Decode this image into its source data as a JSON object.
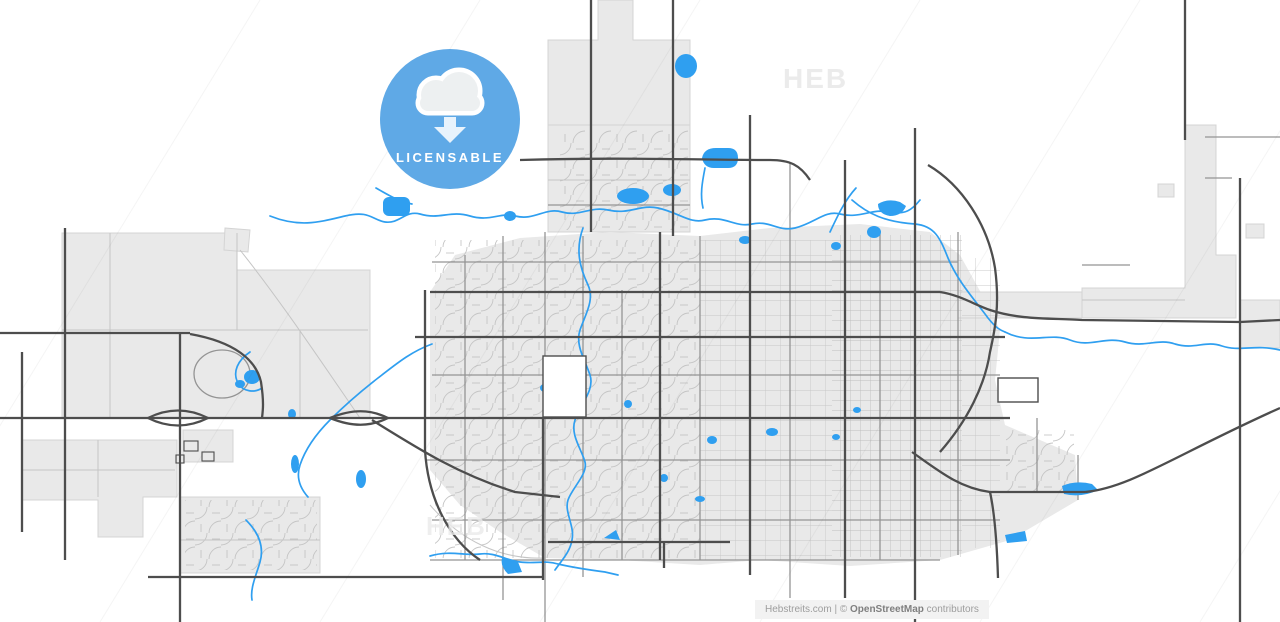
{
  "badge": {
    "label": "LICENSABLE",
    "icon": "cloud-download-icon"
  },
  "watermarks": [
    {
      "text": "HEB"
    },
    {
      "text": "HEB"
    }
  ],
  "footer": {
    "site": "Hebstreits.com",
    "divider": " | ",
    "copyright": "© ",
    "osm": "OpenStreetMap",
    "suffix": " contributors"
  },
  "theme": {
    "background": "#ffffff",
    "land": "#e9e9e9",
    "land-border": "#d4d4d4",
    "road-major": "#4d4d4d",
    "road-mid": "#949494",
    "road-minor": "#c5c5c5",
    "water": "#2f9ff0",
    "watermark": "#ebebeb",
    "badge-bg": "#5fa9e6",
    "badge-icon-fill": "#edf0f1",
    "badge-icon-stroke": "#ffffff",
    "badge-arrow": "#e8f3fc",
    "badge-text": "#ffffff",
    "footer-bg": "#f2f2f2",
    "footer-text": "#9d9d9d",
    "footer-text-strong": "#7f7f7f"
  }
}
